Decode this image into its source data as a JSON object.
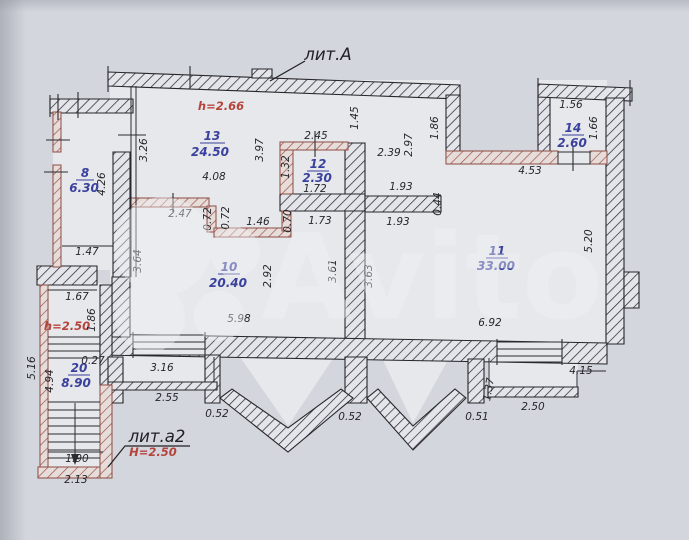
{
  "titles": {
    "building": "лит.А",
    "annex": "лит.а2"
  },
  "heights": {
    "main_room": "h=2.66",
    "annex_upper": "h=2.50",
    "annex_main": "Н=2.50"
  },
  "watermark": {
    "text": "Avito"
  },
  "rooms": [
    {
      "number": "8",
      "area": "6.30"
    },
    {
      "number": "13",
      "area": "24.50"
    },
    {
      "number": "12",
      "area": "2.30"
    },
    {
      "number": "14",
      "area": "2.60"
    },
    {
      "number": "10",
      "area": "20.40"
    },
    {
      "number": "11",
      "area": "33.00"
    },
    {
      "number": "20",
      "area": "8.90"
    }
  ],
  "dims": [
    "1.56",
    "2.45",
    "1.45",
    "1.86",
    "1.66",
    "3.26",
    "3.97",
    "2.97",
    "2.39",
    "4.08",
    "1.32",
    "1.72",
    "4.53",
    "1.93",
    "0.44",
    "1.93",
    "2.47",
    "0.72",
    "0.72",
    "1.46",
    "0.70",
    "1.73",
    "4.26",
    "1.47",
    "3.64",
    "2.92",
    "3.61",
    "3.63",
    "5.20",
    "5.98",
    "6.92",
    "1.67",
    "1.86",
    "0.27",
    "4.94",
    "5.16",
    "3.16",
    "2.55",
    "0.52",
    "0.52",
    "0.51",
    "1.37",
    "2.50",
    "4.15",
    "1.90",
    "2.13"
  ]
}
